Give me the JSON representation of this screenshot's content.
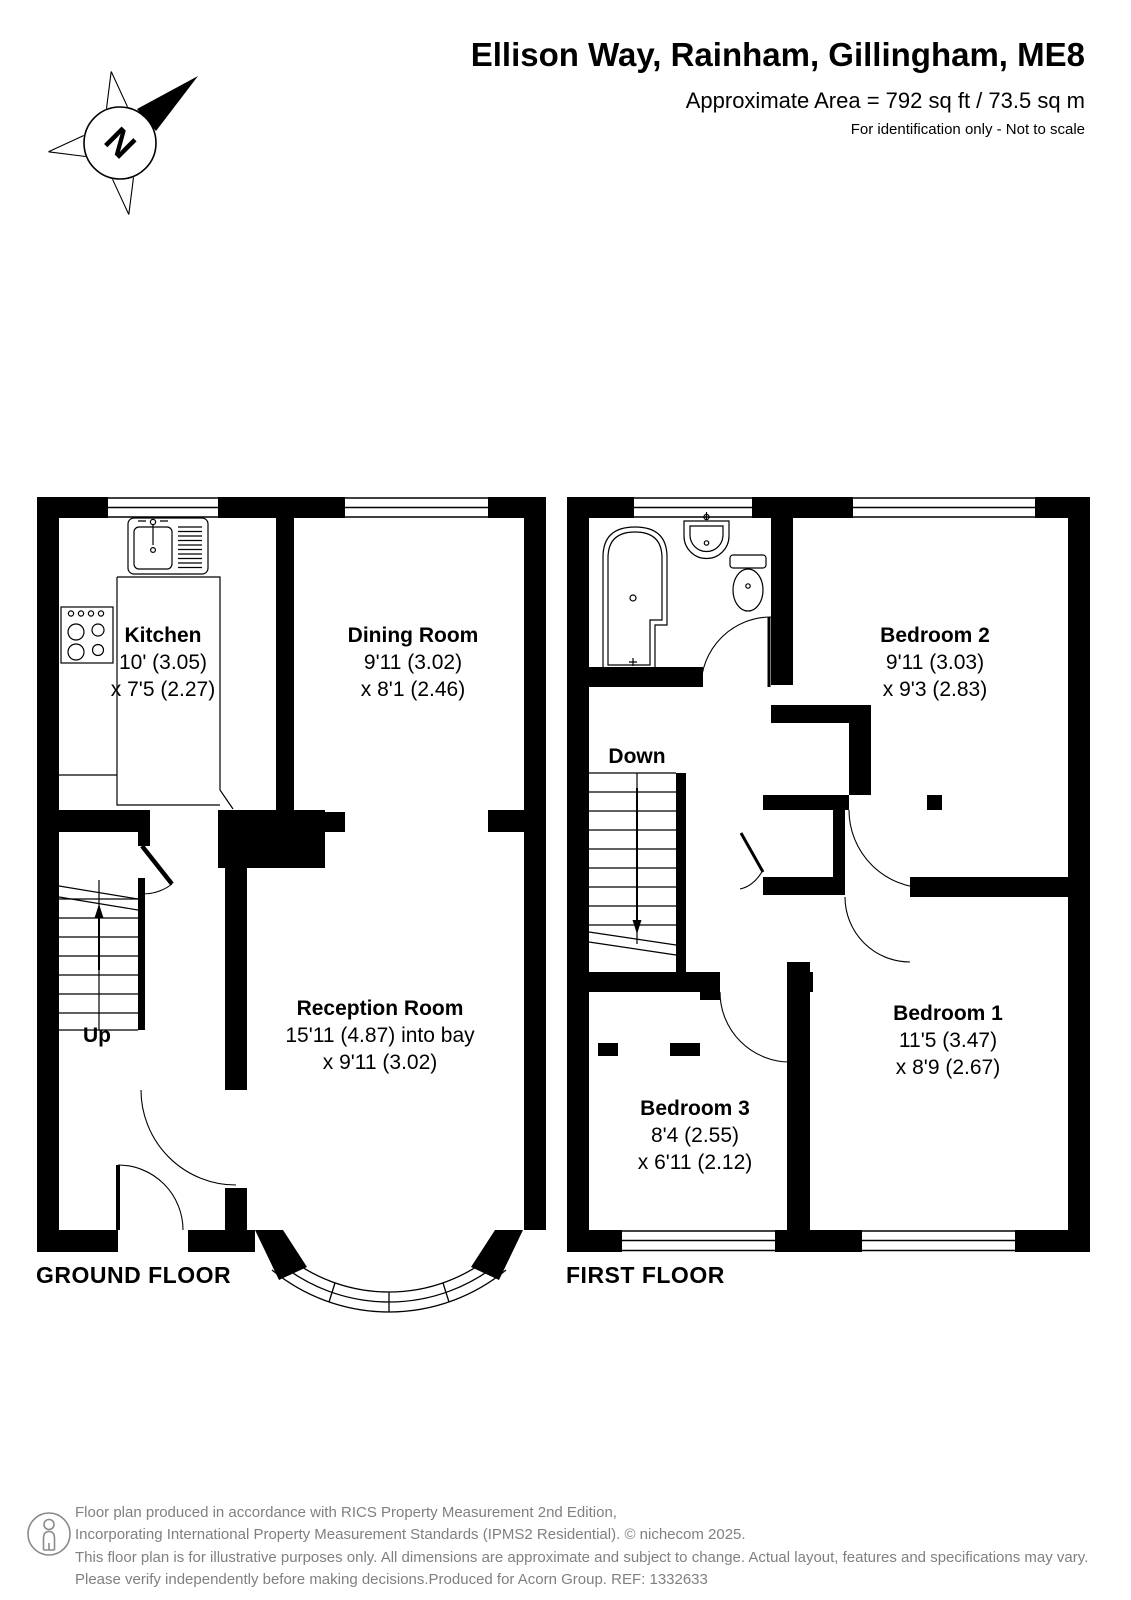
{
  "header": {
    "title": "Ellison Way, Rainham, Gillingham, ME8",
    "area": "Approximate Area = 792 sq ft / 73.5 sq m",
    "note": "For identification only - Not to scale"
  },
  "compass": {
    "north_label": "N"
  },
  "floors": {
    "ground": {
      "name": "GROUND FLOOR",
      "stairs_label": "Up",
      "rooms": {
        "kitchen": {
          "name": "Kitchen",
          "dim1": "10' (3.05)",
          "dim2": "x 7'5 (2.27)"
        },
        "dining": {
          "name": "Dining Room",
          "dim1": "9'11 (3.02)",
          "dim2": "x 8'1 (2.46)"
        },
        "reception": {
          "name": "Reception Room",
          "dim1": "15'11 (4.87) into bay",
          "dim2": "x 9'11 (3.02)"
        }
      }
    },
    "first": {
      "name": "FIRST FLOOR",
      "stairs_label": "Down",
      "rooms": {
        "bedroom2": {
          "name": "Bedroom 2",
          "dim1": "9'11 (3.03)",
          "dim2": "x 9'3 (2.83)"
        },
        "bedroom1": {
          "name": "Bedroom 1",
          "dim1": "11'5 (3.47)",
          "dim2": "x 8'9 (2.67)"
        },
        "bedroom3": {
          "name": "Bedroom 3",
          "dim1": "8'4 (2.55)",
          "dim2": "x 6'11 (2.12)"
        }
      }
    }
  },
  "footer": {
    "line1": "Floor plan produced in accordance with RICS Property Measurement 2nd Edition,",
    "line2": "Incorporating International Property Measurement Standards (IPMS2 Residential).   © nichecom 2025.",
    "line3": "This floor plan is for illustrative purposes only. All dimensions are approximate and subject to change. Actual layout, features and specifications may vary.",
    "line4": "Please verify independently before making decisions.Produced for Acorn Group.   REF: 1332633"
  },
  "colors": {
    "wall": "#000000",
    "footer_text": "#808080"
  }
}
